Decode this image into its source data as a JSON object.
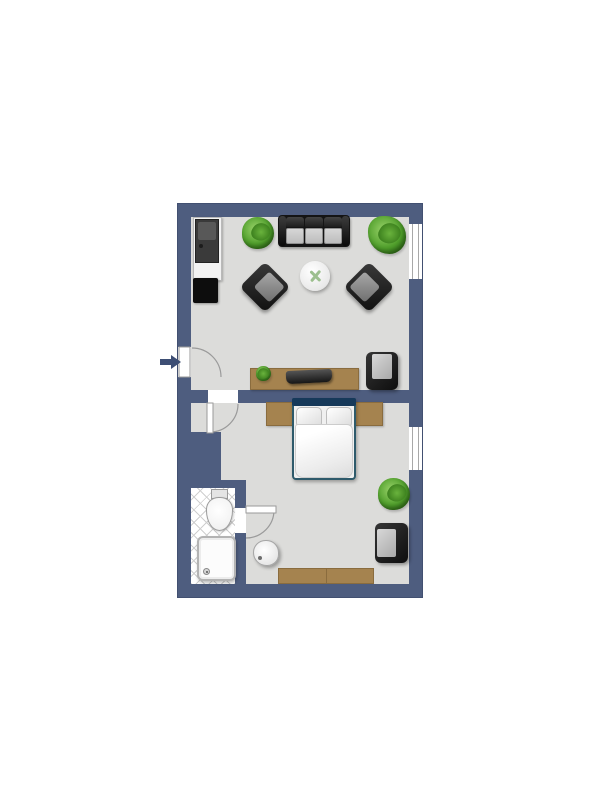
{
  "scene": {
    "type": "apartment-floor-plan",
    "description": "Top-down rendered floor plan of a one-bedroom apartment with living room, bedroom and bathroom",
    "entry": {
      "side": "left",
      "arrow_direction": "right"
    },
    "rooms": [
      {
        "name": "living-room",
        "position": "top",
        "furniture": [
          "kitchenette-unit",
          "refrigerator-appliance",
          "cooktop",
          "potted-plant-left",
          "three-seat-sofa",
          "potted-plant-right",
          "lounge-chair-left",
          "lounge-chair-right",
          "round-coffee-table",
          "table-plant",
          "tv-sideboard",
          "sideboard-plant",
          "tv",
          "armchair"
        ],
        "windows": 1
      },
      {
        "name": "bedroom",
        "position": "bottom",
        "furniture": [
          "double-bed",
          "two-pillows",
          "duvet",
          "headboard-backboard",
          "potted-plant",
          "armchair",
          "dresser",
          "wash-basin"
        ],
        "windows": 1
      },
      {
        "name": "bathroom",
        "position": "bottom-left",
        "furniture": [
          "toilet",
          "shower-tray"
        ],
        "floor": "diagonal-tiles"
      }
    ],
    "doors": [
      "entry-door",
      "living-to-bedroom-door",
      "bathroom-door"
    ]
  },
  "colors": {
    "wall": "#4e5d7f",
    "wall_dark": "#425071",
    "floor": "#dcdcda",
    "wood": "#a5834f",
    "wood_dark": "#8a6c3e",
    "plant": "#4f9e2b",
    "sprig": "#9cbf8e",
    "bed_frame": "#2e5a6b",
    "headboard": "#16395a",
    "tile_line": "#cfcfcf",
    "window_line": "#a8a8a8",
    "arrow": "#3d4e74",
    "background": "#ffffff"
  }
}
